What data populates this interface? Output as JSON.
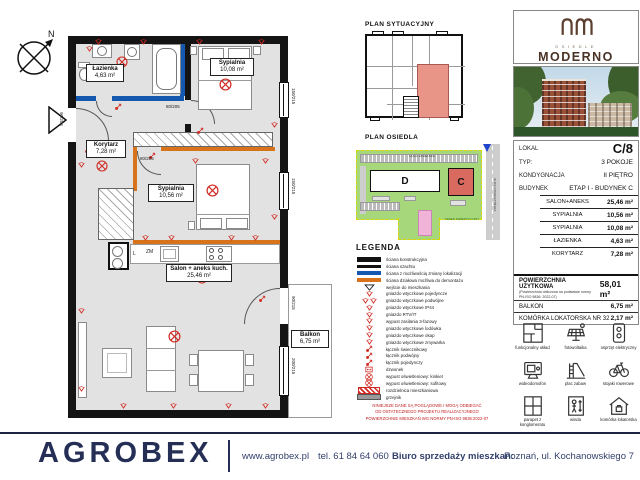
{
  "compass": {
    "north": "N"
  },
  "plan": {
    "rooms": [
      {
        "name": "Łazienka",
        "area": "4,63 m²"
      },
      {
        "name": "Sypialnia",
        "area": "10,08 m²"
      },
      {
        "name": "Korytarz",
        "area": "7,28 m²"
      },
      {
        "name": "Sypialnia",
        "area": "10,56 m²"
      },
      {
        "name": "Salon + aneks kuch.",
        "area": "25,46 m²"
      },
      {
        "name": "Balkon",
        "area": "6,75 m²"
      }
    ],
    "annotations": {
      "zm": "ZM",
      "fridge": "L"
    },
    "dims": {
      "entry": "90/204",
      "door1": "80/205",
      "door2": "80/205",
      "win1": "150/215",
      "win2": "150/215",
      "balc": "90/215",
      "win3": "200/215"
    }
  },
  "plan_sytuacyjny": {
    "title": "PLAN SYTUACYJNY"
  },
  "plan_osiedla": {
    "title": "PLAN OSIEDLA",
    "building_d": "D",
    "building_c": "C",
    "street_top": "ULICA JASIELSKA",
    "street_right": "ULICA STRZESZYŃSKA",
    "area_label": "TEREN INWESTYCYJNY"
  },
  "legend": {
    "title": "LEGENDA",
    "items": [
      {
        "label": "ściana konstrukcyjna"
      },
      {
        "label": "ściana szachtu"
      },
      {
        "label": "ściana z możliwością zmiany lokalizacji"
      },
      {
        "label": "ściana działowa możliwa do demontażu"
      },
      {
        "label": "wejście do mieszkania"
      },
      {
        "label": "gniazdo wtyczkowe pojedyncze"
      },
      {
        "label": "gniazdo wtyczkowe podwójne"
      },
      {
        "label": "gniazdo wtyczkowe IP44"
      },
      {
        "label": "gniazdo RTV/IT"
      },
      {
        "label": "wypust zasilania 3-fazowy"
      },
      {
        "label": "gniazdo wtyczkowe lodówka"
      },
      {
        "label": "gniazdo wtyczkowe okap"
      },
      {
        "label": "gniazdo wtyczkowe zmywarka"
      },
      {
        "label": "łącznik świecznikowy"
      },
      {
        "label": "łącznik podwójny"
      },
      {
        "label": "łącznik pojedynczy"
      },
      {
        "label": "dzwonek"
      },
      {
        "label": "wypust oświetleniowy: kinkiet"
      },
      {
        "label": "wypust oświetleniowy: sufitowy"
      },
      {
        "label": "rozdzielnica mieszkaniowa"
      },
      {
        "label": "grzejnik"
      }
    ],
    "disclaimer": [
      "NINIEJSZE DANE SĄ POGLĄDOWE I MOGĄ ODBIEGAĆ",
      "OD OSTATECZNEGO PROJEKTU REALIZACYJNEGO",
      "POWIERZCHNIE MIESZKAŃ WG NORMY PN-ISO 9836:2022-07"
    ]
  },
  "brand": {
    "osiedle": "OSIEDLE",
    "name": "MODERNO"
  },
  "unit": {
    "info": [
      {
        "label": "LOKAL",
        "value": "C/8"
      },
      {
        "label": "TYP:",
        "value": "3 POKOJE"
      },
      {
        "label": "KONDYGNACJA",
        "value": "II PIĘTRO"
      },
      {
        "label": "BUDYNEK",
        "value": "ETAP I - BUDYNEK C"
      }
    ],
    "areas": [
      {
        "label": "SALON+ANEKS",
        "value": "25,46 m²"
      },
      {
        "label": "SYPIALNIA",
        "value": "10,56 m²"
      },
      {
        "label": "SYPIALNIA",
        "value": "10,08 m²"
      },
      {
        "label": "ŁAZIENKA",
        "value": "4,63 m²"
      },
      {
        "label": "KORYTARZ",
        "value": "7,28 m²"
      }
    ],
    "totals": [
      {
        "label": "POWIERZCHNIA UŻYTKOWA",
        "note": "(Powierzchnia obliczona na podstawie normy PN-ISO 9836: 2022-07)",
        "value": "58,01 m²"
      },
      {
        "label": "BALKON",
        "value": "6,75 m²"
      },
      {
        "label": "KOMÓRKA LOKATORSKA  NR 32",
        "value": "2,17 m²"
      }
    ]
  },
  "features": [
    {
      "label": "funkcjonalny układ"
    },
    {
      "label": "fotowoltaika"
    },
    {
      "label": "osprzęt elektryczny"
    },
    {
      "label": "wideodomofon"
    },
    {
      "label": "plac zabaw"
    },
    {
      "label": "stojaki rowerowe"
    },
    {
      "label": "parapet z konglomeratu"
    },
    {
      "label": "winda"
    },
    {
      "label": "komórka lokatorska"
    }
  ],
  "footer": {
    "logo": "AGROBEX",
    "website": "www.agrobex.pl",
    "phone": "tel. 61 84 64 060",
    "office": "Biuro sprzedaży mieszkań:",
    "address": "Poznań, ul. Kochanowskiego 7"
  }
}
